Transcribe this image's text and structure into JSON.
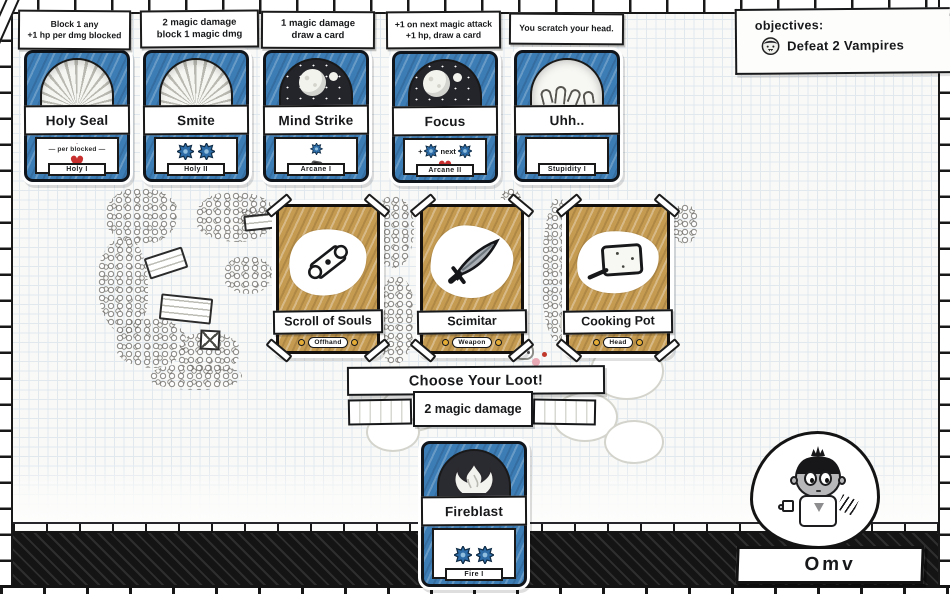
{
  "objectives": {
    "title": "objectives:",
    "item_label": "Defeat 2 Vampires"
  },
  "hand_cards": [
    {
      "name": "Holy Seal",
      "school": "Holy I",
      "tooltip_line1": "Block 1 any",
      "tooltip_line2": "+1 hp per dmg blocked",
      "body_note": "— per blocked —"
    },
    {
      "name": "Smite",
      "school": "Holy II",
      "tooltip_line1": "2 magic damage",
      "tooltip_line2": "block 1 magic dmg"
    },
    {
      "name": "Mind Strike",
      "school": "Arcane I",
      "tooltip_line1": "1 magic damage",
      "tooltip_line2": "draw a card"
    },
    {
      "name": "Focus",
      "school": "Arcane II",
      "tooltip_line1": "+1 on next magic attack",
      "tooltip_line2": "+1 hp, draw a card",
      "body_plus": "+",
      "body_next": "next"
    },
    {
      "name": "Uhh..",
      "school": "Stupidity I",
      "tooltip_line1": "You scratch your head."
    }
  ],
  "loot": {
    "banner": "Choose Your Loot!",
    "cards": [
      {
        "name": "Scroll of Souls",
        "slot": "Offhand"
      },
      {
        "name": "Scimitar",
        "slot": "Weapon"
      },
      {
        "name": "Cooking Pot",
        "slot": "Head"
      }
    ]
  },
  "action": {
    "tooltip": "2 magic damage",
    "card": {
      "name": "Fireblast",
      "school": "Fire I"
    }
  },
  "player": {
    "name": "Omv"
  },
  "colors": {
    "card_blue": "#3d7db6",
    "loot_tan": "#c59b51",
    "star_blue": "#2d6ca6",
    "heart_red": "#c8302f",
    "slot_gold": "#e5ad35"
  }
}
